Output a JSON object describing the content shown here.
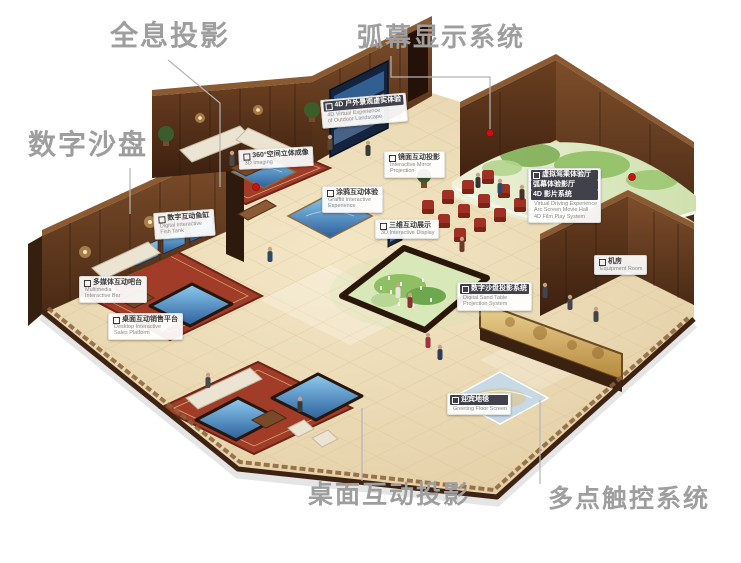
{
  "main_labels": [
    {
      "name": "holographic-projection",
      "text": "全息投影",
      "x": 110,
      "y": 22,
      "size": 28
    },
    {
      "name": "arc-screen-display-system",
      "text": "弧幕显示系统",
      "x": 357,
      "y": 24,
      "size": 26
    },
    {
      "name": "digital-sand-table",
      "text": "数字沙盘",
      "x": 28,
      "y": 131,
      "size": 28
    },
    {
      "name": "desktop-interactive-projection",
      "text": "桌面互动投影",
      "x": 308,
      "y": 483,
      "size": 25
    },
    {
      "name": "multi-touch-system",
      "text": "多点触控系统",
      "x": 548,
      "y": 487,
      "size": 25
    }
  ],
  "callouts": [
    {
      "name": "callout-4d-outdoor-landscape",
      "zh": [
        "4D 户外景观虚实体验"
      ],
      "en": [
        "4D Virtual Experience",
        "of Outdoor Landscape"
      ],
      "x": 320,
      "y": 100,
      "rot": -5,
      "ribbon": true
    },
    {
      "name": "callout-360-imaging",
      "zh": [
        "360°空间立体成像"
      ],
      "en": [
        "3D Imaging"
      ],
      "x": 238,
      "y": 150,
      "rot": -3,
      "ribbon": false
    },
    {
      "name": "callout-mirror-projection",
      "zh": [
        "镜面互动投影"
      ],
      "en": [
        "Interactive Mirror",
        "Projection"
      ],
      "x": 384,
      "y": 151,
      "rot": 0,
      "ribbon": false
    },
    {
      "name": "callout-graffiti-experience",
      "zh": [
        "涂鸦互动体验"
      ],
      "en": [
        "Graffiti Interactive",
        "Experience"
      ],
      "x": 322,
      "y": 186,
      "rot": 0,
      "ribbon": false
    },
    {
      "name": "callout-digital-fish-tank",
      "zh": [
        "数字互动鱼缸"
      ],
      "en": [
        "Digital Interactive",
        "Fish Tank"
      ],
      "x": 153,
      "y": 213,
      "rot": -4,
      "ribbon": false
    },
    {
      "name": "callout-multimedia-bar",
      "zh": [
        "多媒体互动吧台"
      ],
      "en": [
        "Multimedia",
        "Interactive Bar"
      ],
      "x": 79,
      "y": 276,
      "rot": 0,
      "ribbon": false
    },
    {
      "name": "callout-desktop-sales-platform",
      "zh": [
        "桌面互动销售平台"
      ],
      "en": [
        "Desktop Interactive",
        "Sales Platform"
      ],
      "x": 108,
      "y": 313,
      "rot": 0,
      "ribbon": false
    },
    {
      "name": "callout-3d-interactive-display",
      "zh": [
        "三维互动展示"
      ],
      "en": [
        "3D Interactive Display"
      ],
      "x": 375,
      "y": 219,
      "rot": 0,
      "ribbon": false
    },
    {
      "name": "callout-sand-table-projection",
      "zh": [
        "数字沙盘投影系统"
      ],
      "en": [
        "Digital Sand Table",
        "Projection System"
      ],
      "x": 457,
      "y": 282,
      "rot": 0,
      "ribbon": true
    },
    {
      "name": "callout-virtual-driving",
      "zh": [
        "虚拟驾乘体验厅",
        "弧幕体验影厅",
        "4D 影片系统"
      ],
      "en": [
        "Virtual Driving Experience",
        "Arc Screen Movie Hall",
        "4D Film Play System"
      ],
      "x": 528,
      "y": 168,
      "rot": 0,
      "ribbon": true
    },
    {
      "name": "callout-equipment-room",
      "zh": [
        "机房"
      ],
      "en": [
        "Equipment Room"
      ],
      "x": 594,
      "y": 255,
      "rot": 0,
      "ribbon": false
    },
    {
      "name": "callout-greeting-floor-screen",
      "zh": [
        "迎宾地毯"
      ],
      "en": [
        "Greeting Floor Screen"
      ],
      "x": 447,
      "y": 393,
      "rot": 0,
      "ribbon": true
    }
  ],
  "colors": {
    "label_gray": "#9e9e9e",
    "connector_gray": "#b5b5b5",
    "dot_red": "#cc1111",
    "wall_wood": "#5d3a22",
    "floor_beige": "#ead9b6",
    "carpet_red": "#9c3b28",
    "screen_blue": "#4f86b8",
    "sand_table_green": "#a9c87e",
    "mural_gold": "#d4af5e"
  }
}
